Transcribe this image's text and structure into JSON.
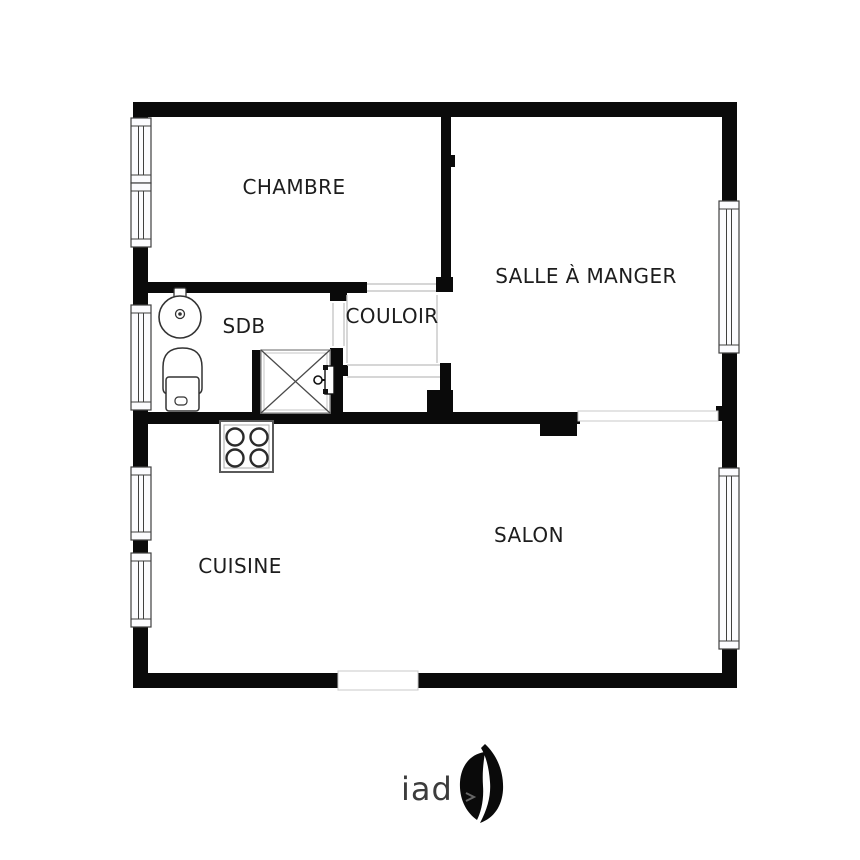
{
  "rooms": {
    "chambre": {
      "label": "CHAMBRE",
      "x": 294,
      "y": 187
    },
    "salle_a_manger": {
      "label": "SALLE À MANGER",
      "x": 586,
      "y": 276
    },
    "sdb": {
      "label": "SDB",
      "x": 244,
      "y": 326
    },
    "couloir": {
      "label": "COULOIR",
      "x": 392,
      "y": 316
    },
    "cuisine": {
      "label": "CUISINE",
      "x": 240,
      "y": 566
    },
    "salon": {
      "label": "SALON",
      "x": 529,
      "y": 535
    }
  },
  "colors": {
    "wall": "#0a0a0a",
    "window_stroke": "#3f3f3f",
    "window_fill": "#fbfbfe",
    "light_line": "#c8c8c8",
    "fixture_stroke": "#333333",
    "fixture_light": "#9a9a9a",
    "label": "#1d1d1d",
    "brand": "#3c3c3c"
  },
  "plan": {
    "walls": [
      [
        133,
        102,
        604,
        15
      ],
      [
        133,
        102,
        15,
        586
      ],
      [
        722,
        102,
        15,
        586
      ],
      [
        133,
        673,
        604,
        15
      ],
      [
        133,
        282,
        234,
        11
      ],
      [
        330,
        293,
        17,
        8
      ],
      [
        441,
        117,
        10,
        160
      ],
      [
        436,
        277,
        17,
        15
      ],
      [
        451,
        155,
        4,
        12
      ],
      [
        440,
        363,
        11,
        27
      ],
      [
        427,
        390,
        26,
        23
      ],
      [
        133,
        412,
        447,
        12
      ],
      [
        540,
        424,
        37,
        12
      ],
      [
        252,
        350,
        9,
        63
      ],
      [
        330,
        348,
        13,
        66
      ],
      [
        343,
        365,
        5,
        11
      ],
      [
        716,
        406,
        7,
        15
      ]
    ],
    "windows": [
      {
        "x": 131,
        "y1": 118,
        "y2": 183
      },
      {
        "x": 131,
        "y1": 183,
        "y2": 247
      },
      {
        "x": 131,
        "y1": 305,
        "y2": 410
      },
      {
        "x": 131,
        "y1": 467,
        "y2": 540
      },
      {
        "x": 131,
        "y1": 553,
        "y2": 627
      },
      {
        "x": 719,
        "y1": 201,
        "y2": 353
      },
      {
        "x": 719,
        "y1": 468,
        "y2": 649
      }
    ],
    "window_thickness": 20,
    "door_gaps": [
      {
        "x": 338,
        "y": 671,
        "w": 80,
        "h": 19
      }
    ],
    "boundary_band": {
      "x": 578,
      "y": 411,
      "w": 140,
      "h": 10
    },
    "threshold_lines": [
      [
        367,
        284,
        436,
        284
      ],
      [
        367,
        291,
        436,
        291
      ],
      [
        347,
        365,
        440,
        365
      ],
      [
        347,
        377,
        440,
        377
      ],
      [
        347,
        295,
        347,
        363
      ],
      [
        437,
        295,
        437,
        363
      ],
      [
        333,
        303,
        333,
        346
      ],
      [
        344,
        303,
        344,
        346
      ]
    ],
    "fixtures": {
      "sink": {
        "cx": 180,
        "cy": 317,
        "r": 21,
        "tap": [
          174,
          288,
          12,
          14
        ],
        "drain_r": 4.5
      },
      "toilet": {
        "bowl": [
          163,
          348,
          39,
          46
        ],
        "base": [
          166,
          377,
          33,
          34
        ],
        "button": [
          175,
          397,
          12,
          8
        ]
      },
      "shower": {
        "box": [
          261,
          350,
          69,
          63
        ]
      },
      "stove": {
        "box": [
          220,
          421,
          53,
          51
        ],
        "burners": [
          [
            235,
            437
          ],
          [
            259,
            437
          ],
          [
            235,
            458
          ],
          [
            259,
            458
          ]
        ],
        "burner_r": 8.5
      },
      "door_leaf": {
        "rect": [
          325,
          366,
          9,
          28
        ],
        "knob": [
          318,
          380
        ],
        "hinges": [
          [
            323,
            365,
            5,
            5
          ],
          [
            323,
            389,
            5,
            5
          ]
        ]
      }
    }
  },
  "footer": {
    "brand": "iad"
  }
}
